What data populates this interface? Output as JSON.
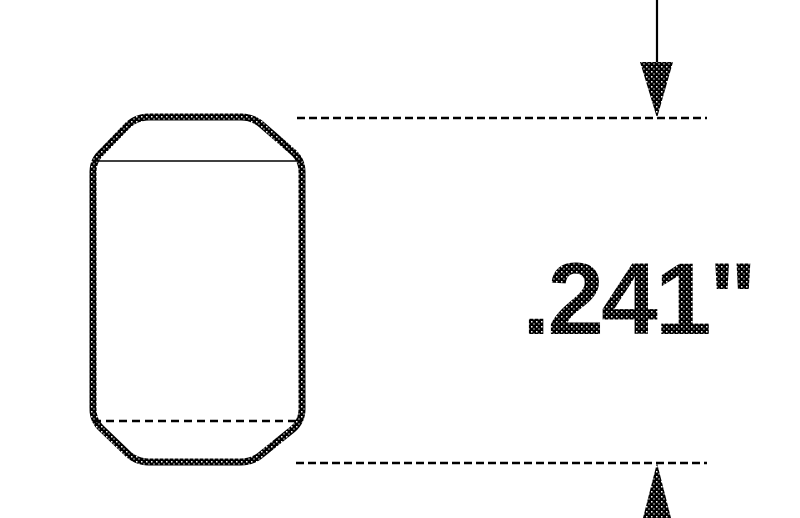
{
  "drawing": {
    "dimension_label": ".241\"",
    "colors": {
      "ink": "#000000",
      "background": "#ffffff"
    }
  }
}
